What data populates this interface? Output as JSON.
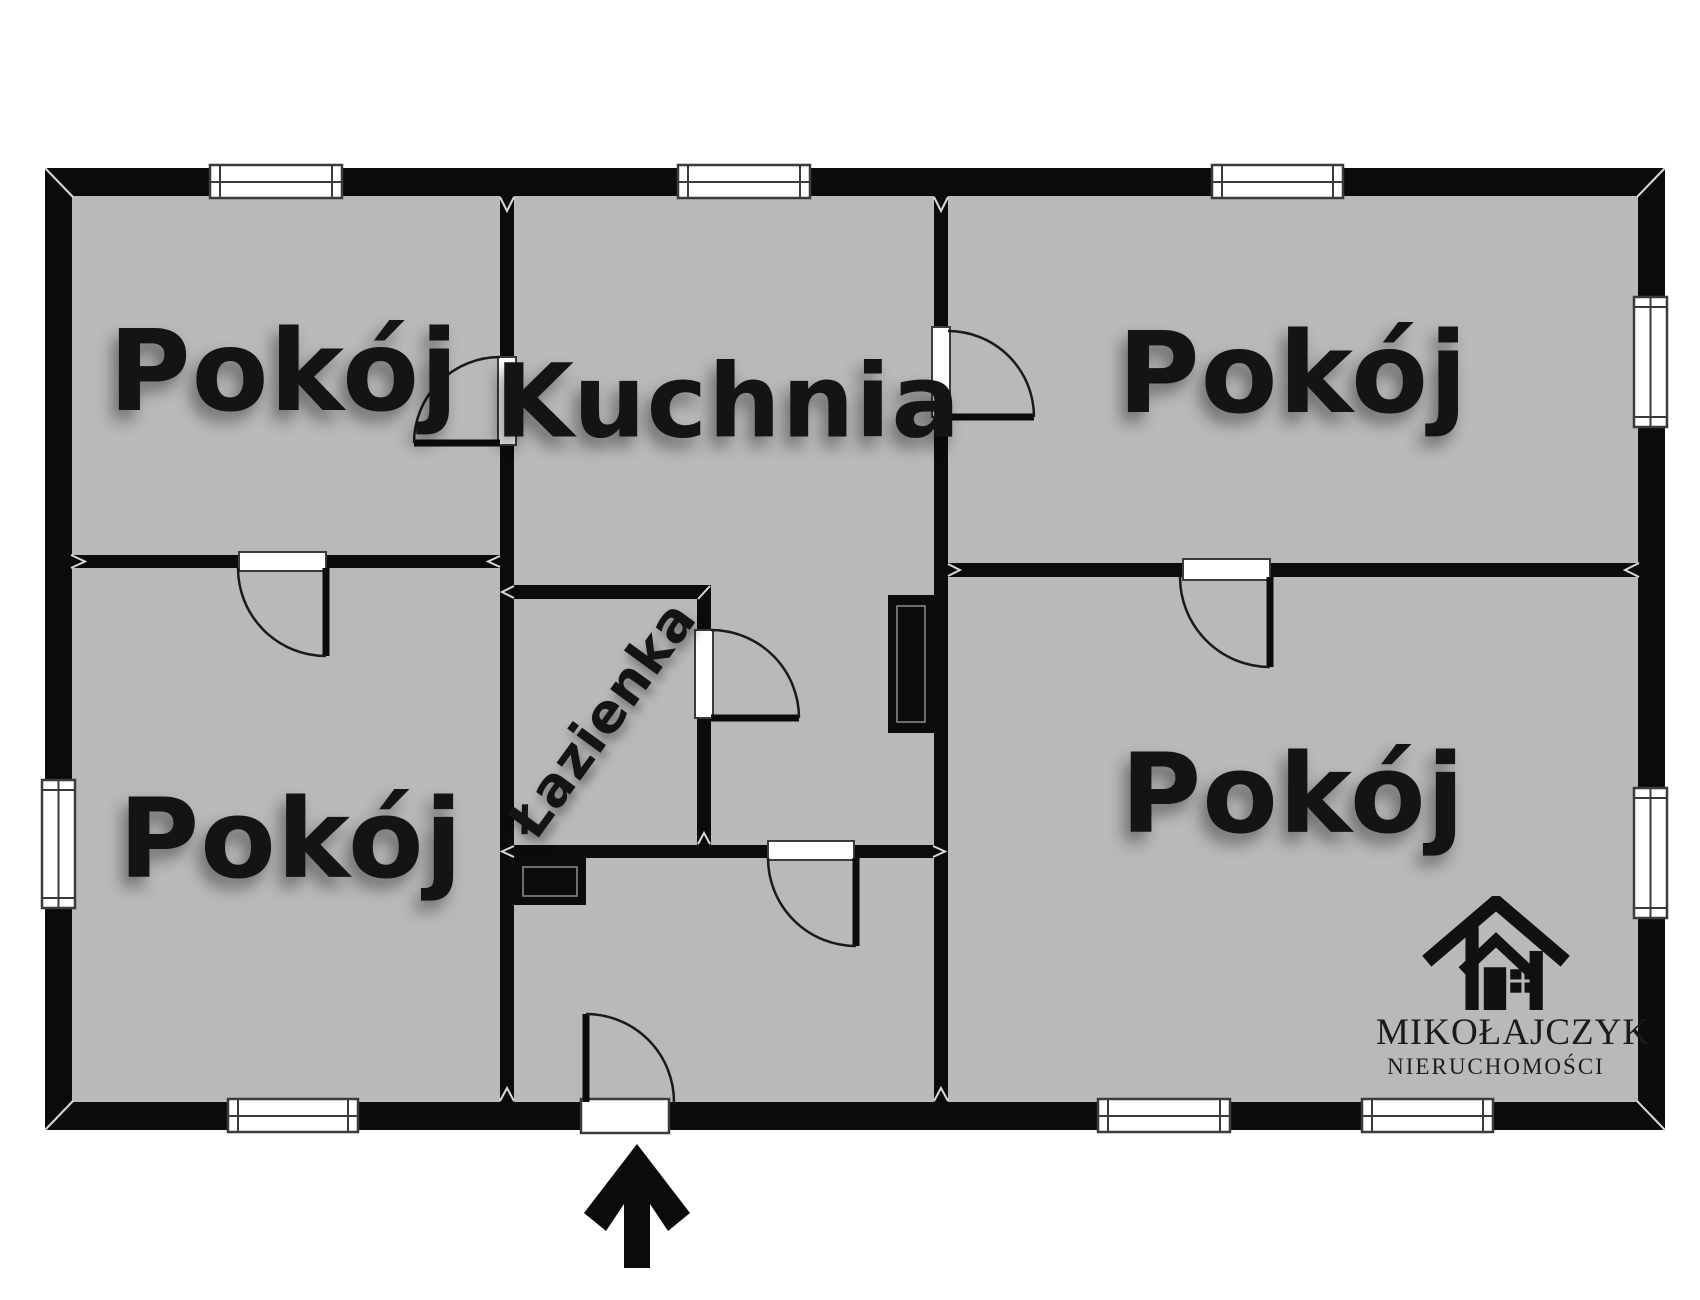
{
  "floor_plan": {
    "rooms": [
      {
        "name": "room-top-left",
        "label": "Pokój"
      },
      {
        "name": "kitchen",
        "label": "Kuchnia"
      },
      {
        "name": "room-top-right",
        "label": "Pokój"
      },
      {
        "name": "room-bottom-left",
        "label": "Pokój"
      },
      {
        "name": "bathroom",
        "label": "Łazienka"
      },
      {
        "name": "room-bottom-right",
        "label": "Pokój"
      }
    ],
    "entrance_arrow": {
      "direction": "up",
      "symbol": "arrow-up"
    },
    "colors": {
      "background": "#ffffff",
      "wall": "#0b0b0b",
      "floor": "#b9b9b9",
      "window_fill": "#ffffff",
      "window_border": "#3b3b3b",
      "door_line": "#1a1a1a"
    }
  },
  "branding": {
    "company": "MIKOŁAJCZYK",
    "subtitle": "NIERUCHOMOŚCI",
    "logo_icon": "house-icon"
  }
}
